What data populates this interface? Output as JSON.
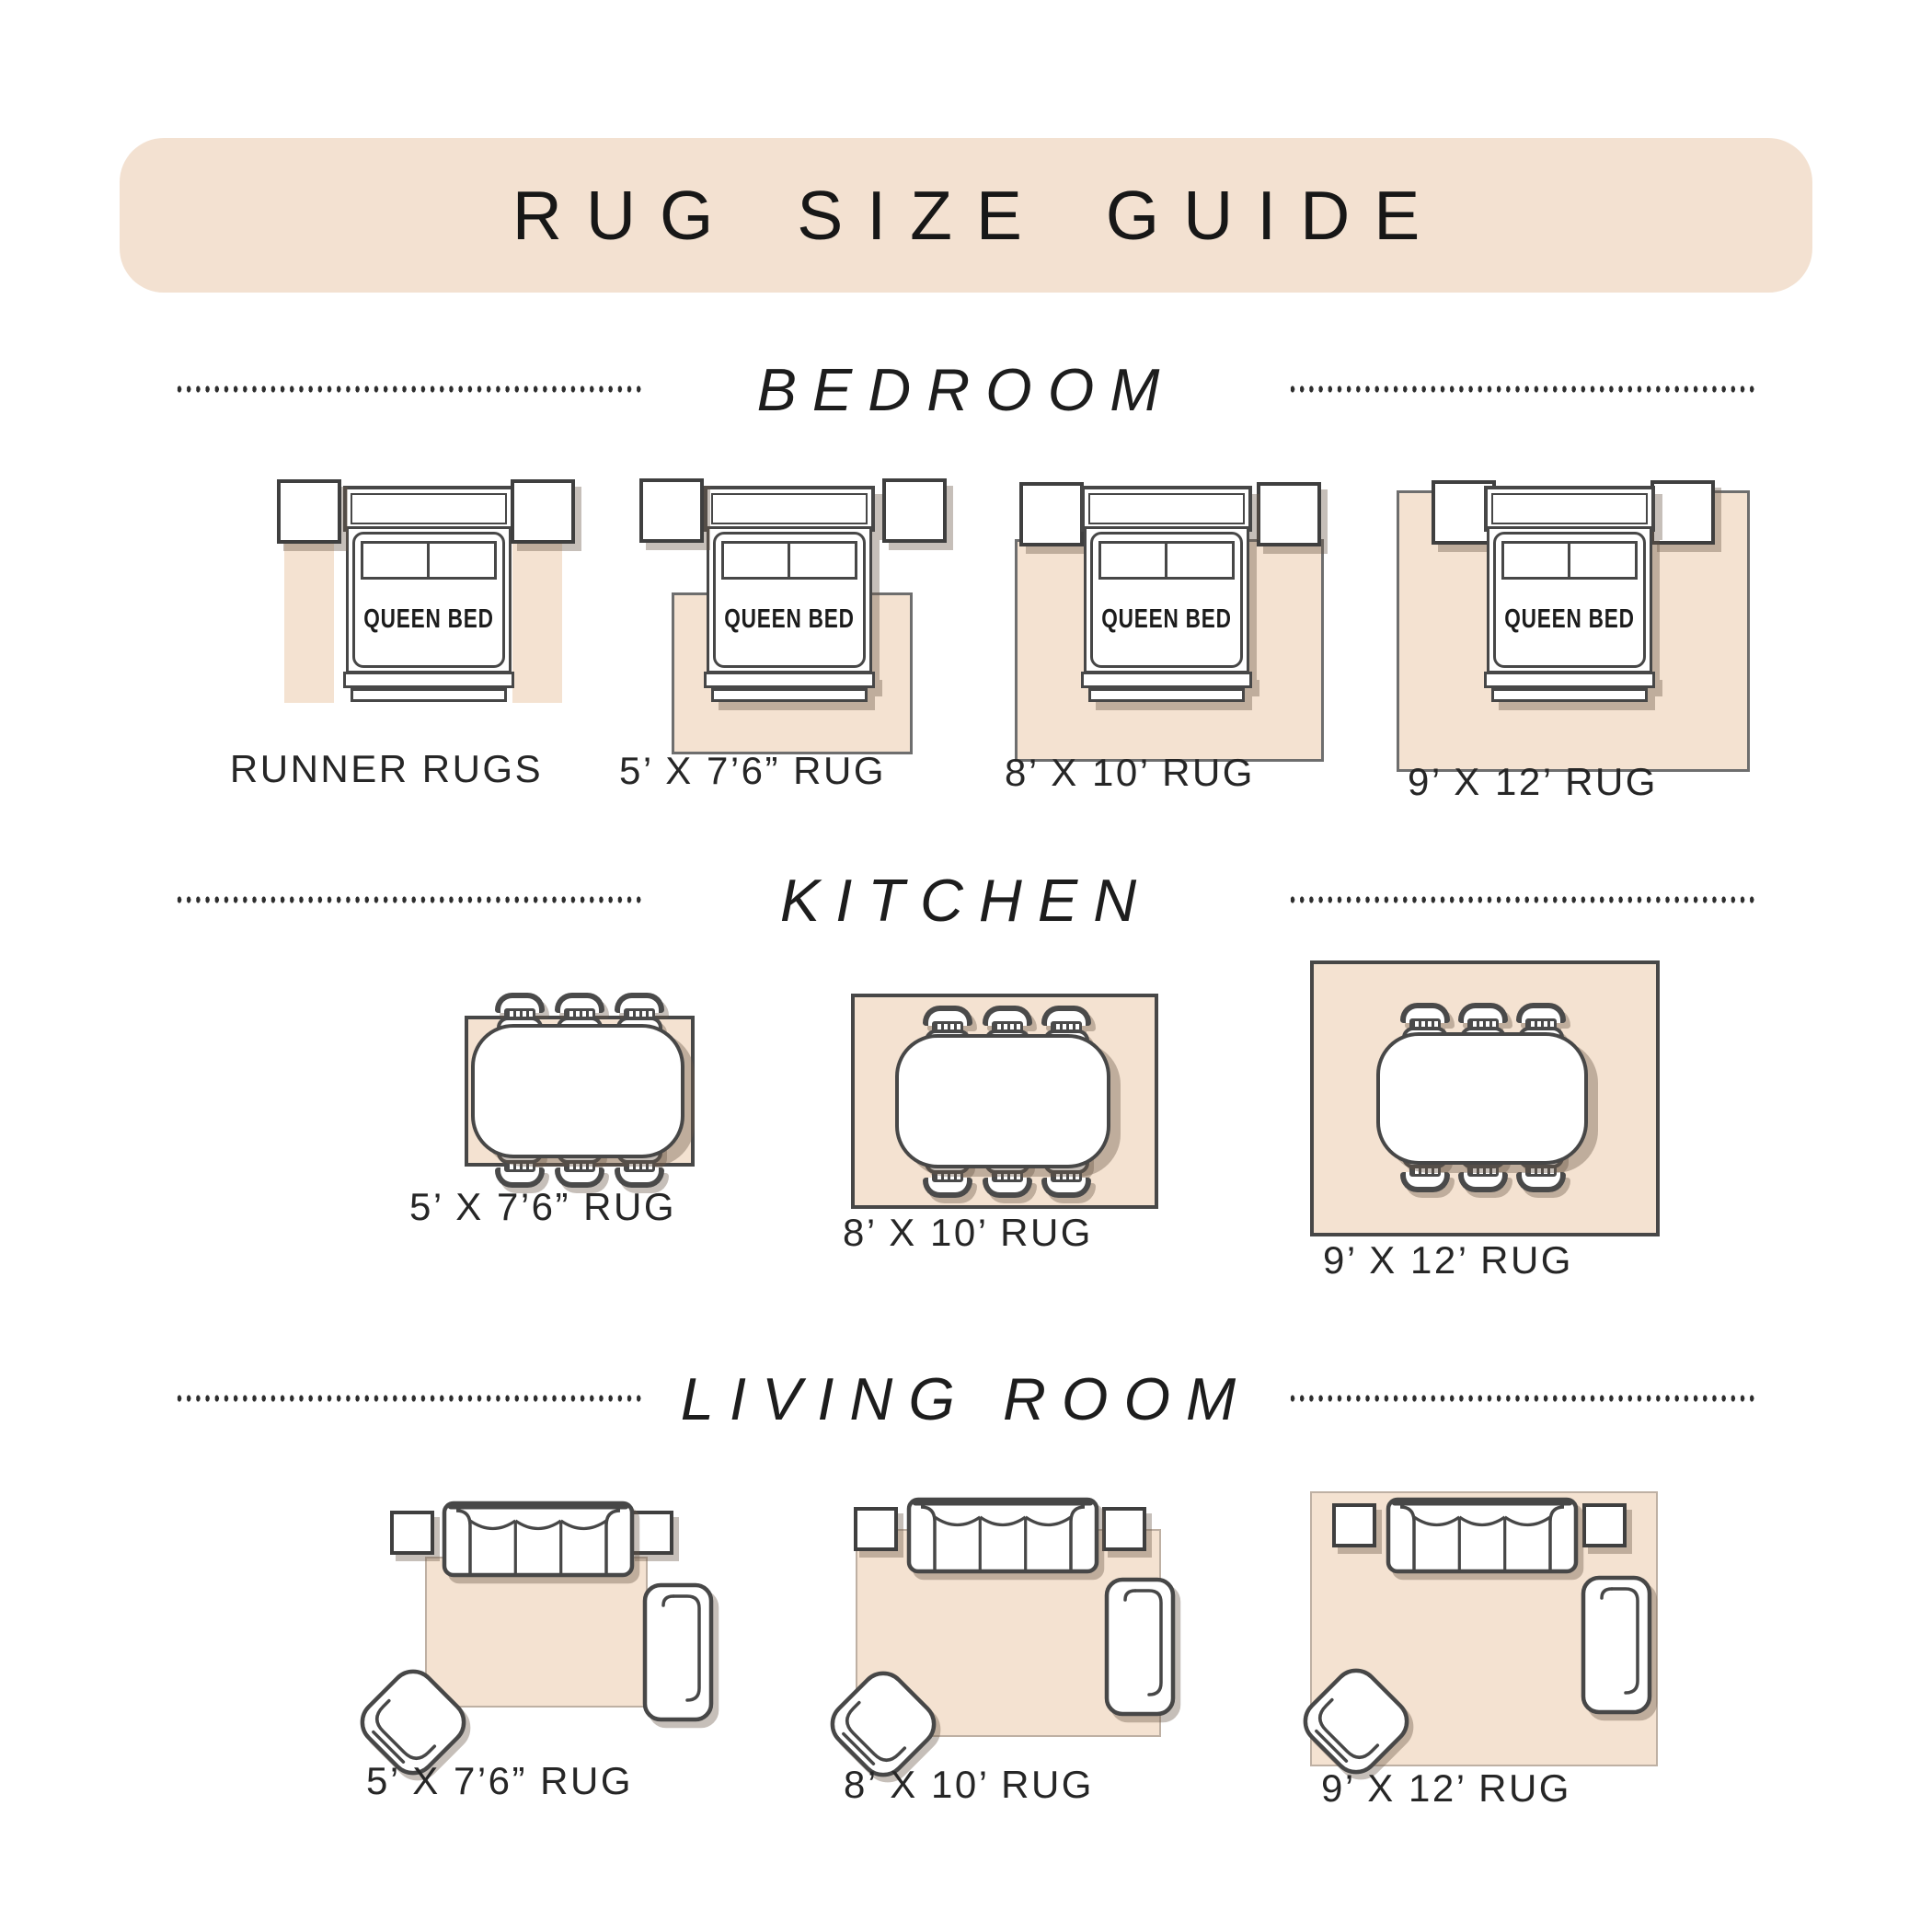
{
  "title": "RUG SIZE GUIDE",
  "bed_label": "QUEEN BED",
  "sections": [
    {
      "name": "BEDROOM",
      "items": [
        {
          "label": "RUNNER RUGS"
        },
        {
          "label": "5’ X 7’6” RUG"
        },
        {
          "label": "8’ X 10’ RUG"
        },
        {
          "label": "9’ X 12’ RUG"
        }
      ]
    },
    {
      "name": "KITCHEN",
      "items": [
        {
          "label": "5’ X 7’6” RUG"
        },
        {
          "label": "8’ X 10’ RUG"
        },
        {
          "label": "9’ X 12’ RUG"
        }
      ]
    },
    {
      "name": "LIVING ROOM",
      "items": [
        {
          "label": "5’ X 7’6” RUG"
        },
        {
          "label": "8’ X 10’ RUG"
        },
        {
          "label": "9’ X 12’ RUG"
        }
      ]
    }
  ],
  "colors": {
    "banner_bg": "#f3e1d1",
    "rug_fill": "#f4e2d1",
    "outline": "#474747",
    "ink": "#262626",
    "shadow": "rgba(104,88,72,0.38)"
  }
}
